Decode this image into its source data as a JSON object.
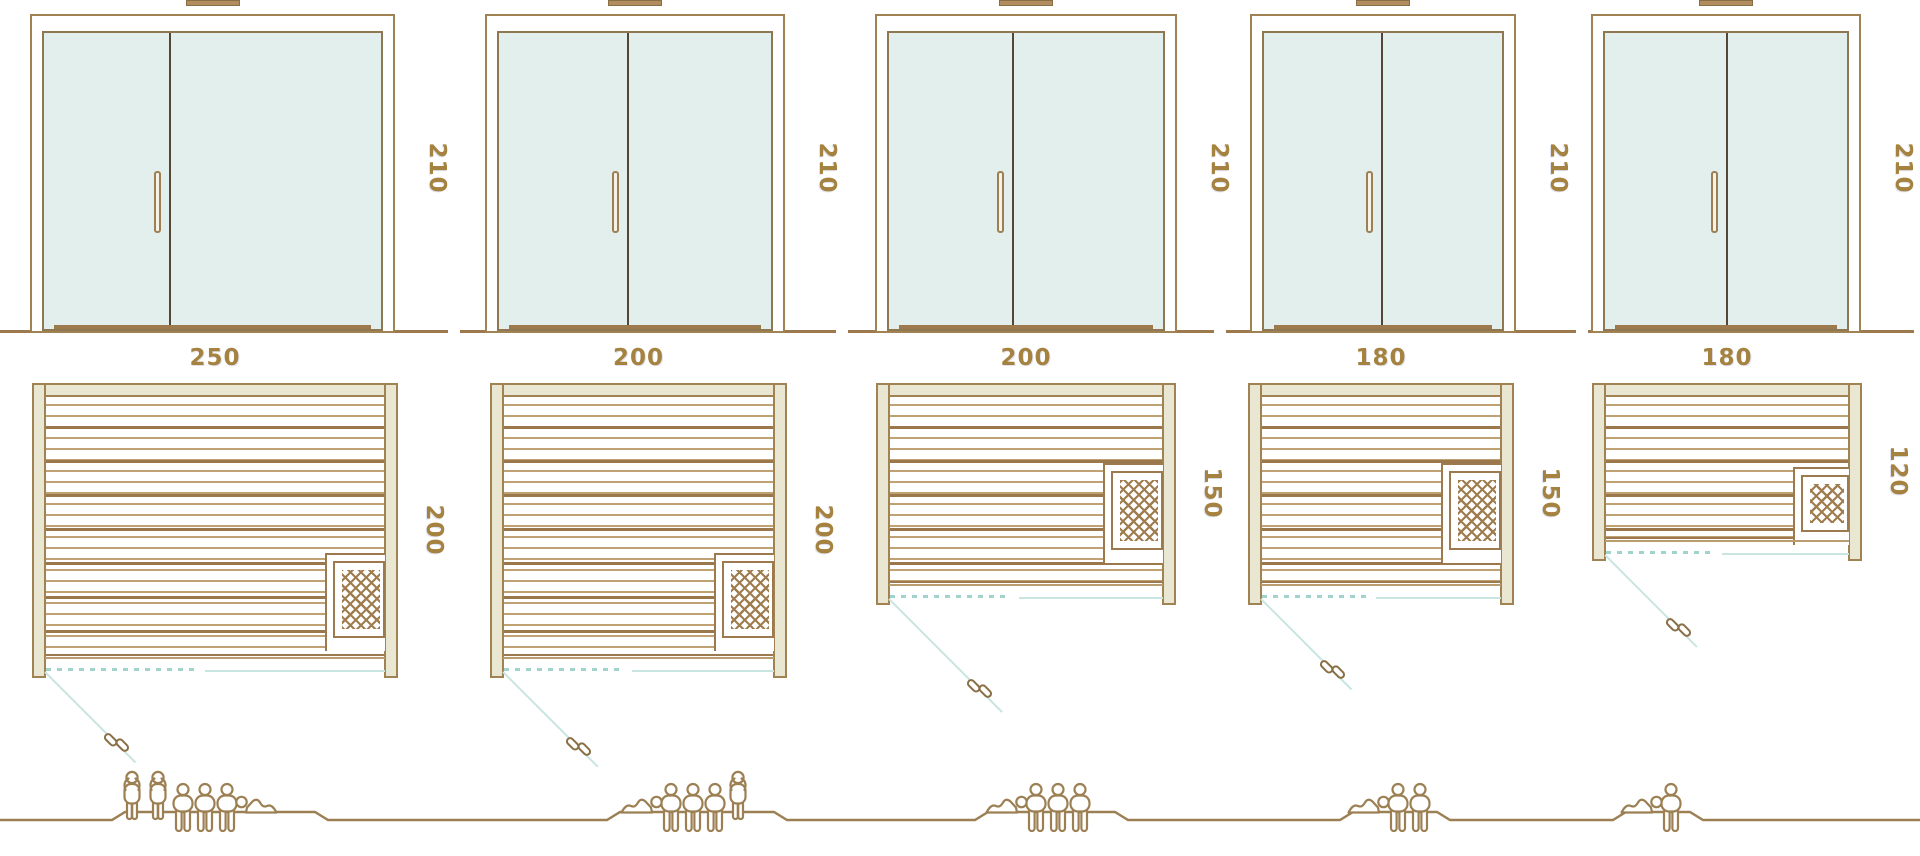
{
  "diagram_title": "Sauna size comparison diagram",
  "colors": {
    "outline_brown": "#9c7a4e",
    "frame_brown": "#a08253",
    "beige_fill": "#e9e6d2",
    "glass_teal": "#e2efec",
    "line_teal": "#c9e5e1",
    "dashed_teal": "#9fd3cb",
    "label_gold": "#a5823f",
    "door_divider_dark": "#554738"
  },
  "units": "cm",
  "saunas": [
    {
      "door_height_cm": "210",
      "width_cm": "250",
      "depth_cm": "200",
      "capacity": 6,
      "figures": [
        "standing",
        "standing",
        "sitting",
        "sitting",
        "sitting",
        "lying"
      ]
    },
    {
      "door_height_cm": "210",
      "width_cm": "200",
      "depth_cm": "200",
      "capacity": 5,
      "figures": [
        "lying",
        "sitting",
        "sitting",
        "sitting",
        "standing"
      ]
    },
    {
      "door_height_cm": "210",
      "width_cm": "200",
      "depth_cm": "150",
      "capacity": 4,
      "figures": [
        "lying",
        "sitting",
        "sitting",
        "sitting"
      ]
    },
    {
      "door_height_cm": "210",
      "width_cm": "180",
      "depth_cm": "150",
      "capacity": 3,
      "figures": [
        "lying",
        "sitting",
        "sitting"
      ]
    },
    {
      "door_height_cm": "210",
      "width_cm": "180",
      "depth_cm": "120",
      "capacity": 2,
      "figures": [
        "lying",
        "sitting"
      ]
    }
  ]
}
